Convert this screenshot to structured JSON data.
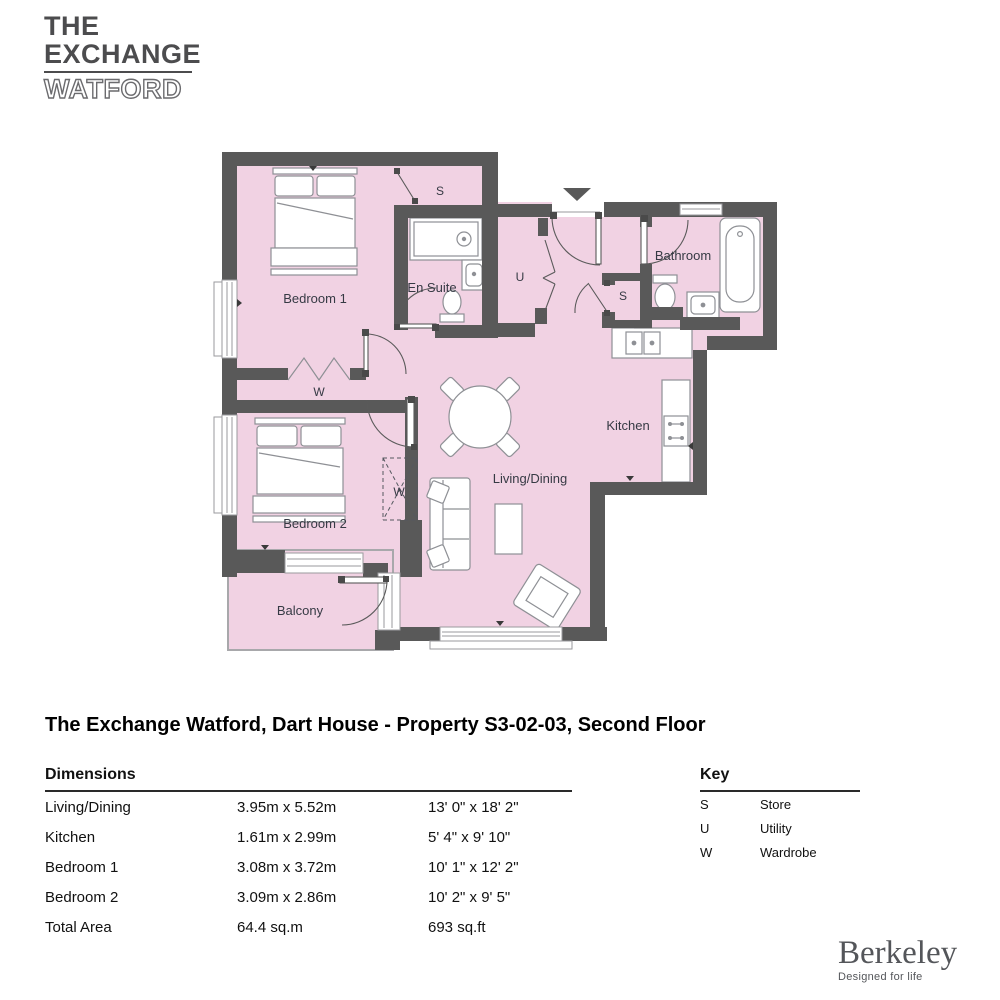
{
  "logo": {
    "line1": "THE",
    "line2": "EXCHANGE",
    "line3": "WATFORD"
  },
  "floorplan": {
    "labels": {
      "bedroom1": "Bedroom 1",
      "ensuite": "En Suite",
      "store_top": "S",
      "utility": "U",
      "bathroom": "Bathroom",
      "store_mid": "S",
      "kitchen": "Kitchen",
      "wardrobe1": "W",
      "bedroom2": "Bedroom 2",
      "wardrobe2": "W",
      "living": "Living/Dining",
      "balcony": "Balcony"
    },
    "colors": {
      "wall": "#595959",
      "floor": "#f1d2e3",
      "fixture_stroke": "#8e9095",
      "label": "#363a44"
    }
  },
  "title": "The Exchange Watford, Dart House - Property S3-02-03, Second Floor",
  "dimensions": {
    "header": "Dimensions",
    "rows": [
      {
        "name": "Living/Dining",
        "metric": "3.95m x 5.52m",
        "imperial": "13' 0\" x 18' 2\""
      },
      {
        "name": "Kitchen",
        "metric": "1.61m x 2.99m",
        "imperial": "5' 4\" x 9' 10\""
      },
      {
        "name": "Bedroom 1",
        "metric": "3.08m x 3.72m",
        "imperial": "10' 1\" x 12' 2\""
      },
      {
        "name": "Bedroom 2",
        "metric": "3.09m x 2.86m",
        "imperial": "10' 2\" x 9' 5\""
      },
      {
        "name": "Total Area",
        "metric": "64.4 sq.m",
        "imperial": "693 sq.ft"
      }
    ]
  },
  "key": {
    "header": "Key",
    "items": [
      {
        "abbr": "S",
        "label": "Store"
      },
      {
        "abbr": "U",
        "label": "Utility"
      },
      {
        "abbr": "W",
        "label": "Wardrobe"
      }
    ]
  },
  "brand": {
    "name": "Berkeley",
    "tagline": "Designed for life"
  }
}
